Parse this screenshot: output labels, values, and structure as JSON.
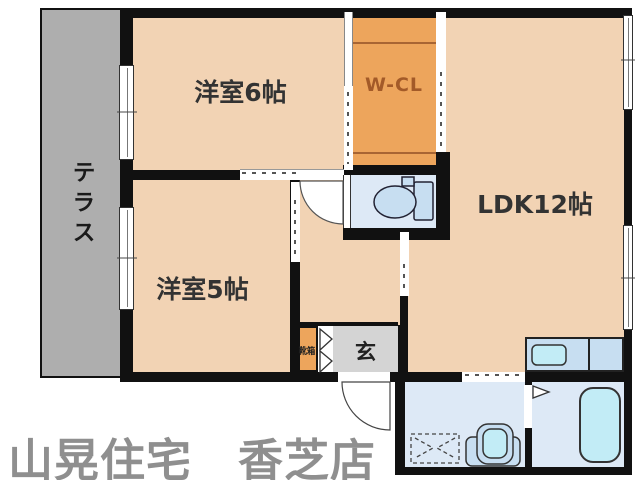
{
  "labels": {
    "terrace": "テラス",
    "bedroom6": "洋室6帖",
    "closet": "W-CL",
    "ldk": "LDK12帖",
    "bedroom5": "洋室5帖",
    "entrance": "玄",
    "shoe_box": "靴箱",
    "footer": "山晃住宅　香芝店"
  },
  "colors": {
    "wall": "#111111",
    "room_peach": "#F2D3B4",
    "closet_orange": "#EDA55C",
    "terrace_gray": "#AEAEAE",
    "entrance_gray": "#D4D4D4",
    "wet_room_blue": "#DDE9F6",
    "fixture_blue": "#C7DEF1",
    "water_cyan": "#C2ECF6",
    "footer_gray": "#8F8F8F",
    "closet_text": "#A35A28"
  }
}
